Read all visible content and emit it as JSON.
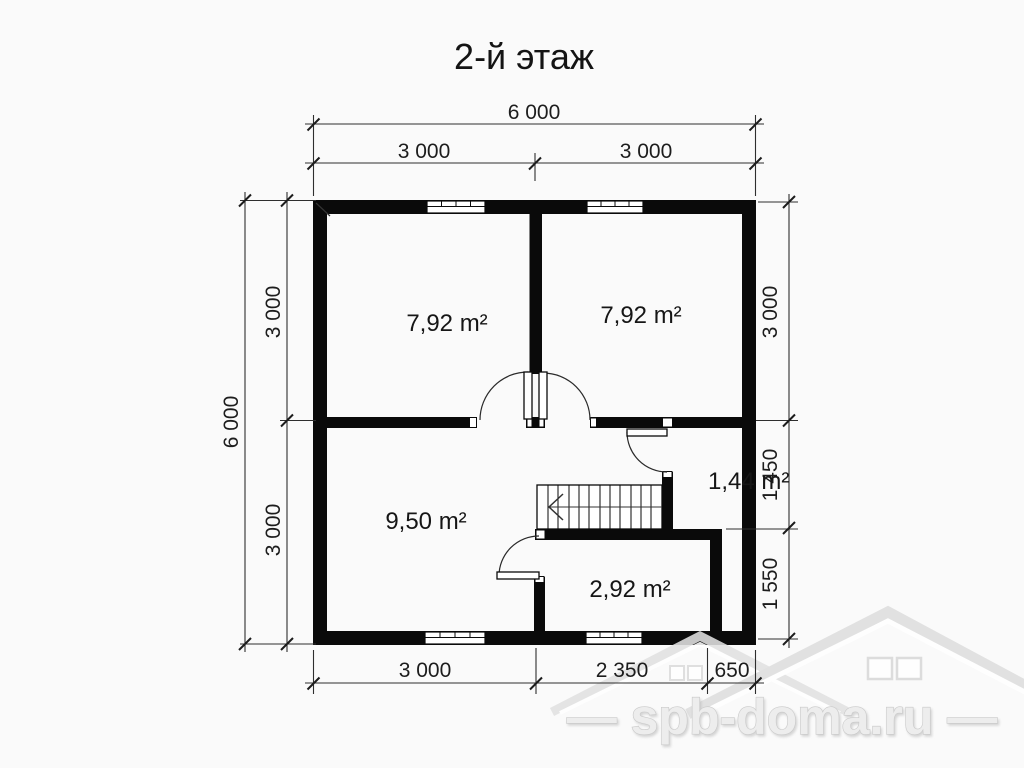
{
  "title": "2-й этаж",
  "floor_plan": {
    "rooms": [
      {
        "name": "top-left-room",
        "area_label": "7,92 m²"
      },
      {
        "name": "top-right-room",
        "area_label": "7,92 m²"
      },
      {
        "name": "closet",
        "area_label": "1,44 m²"
      },
      {
        "name": "bottom-left-room",
        "area_label": "9,50 m²"
      },
      {
        "name": "bottom-middle-room",
        "area_label": "2,92 m²"
      }
    ],
    "dimensions": {
      "top": {
        "total": "6 000",
        "segments": [
          "3 000",
          "3 000"
        ]
      },
      "left": {
        "total": "6 000",
        "segments": [
          "3 000",
          "3 000"
        ]
      },
      "right": {
        "segments": [
          "3 000",
          "1 450",
          "1 550"
        ]
      },
      "bottom": {
        "segments": [
          "3 000",
          "2 350",
          "650"
        ]
      }
    }
  },
  "watermark": {
    "text": "— spb-doma.ru —",
    "logo": "house-roofs-logo"
  },
  "colors": {
    "wall": "#0a0a0a",
    "background": "#fafafa",
    "dimension_line": "#2e2e2e",
    "watermark": "#ededed"
  }
}
